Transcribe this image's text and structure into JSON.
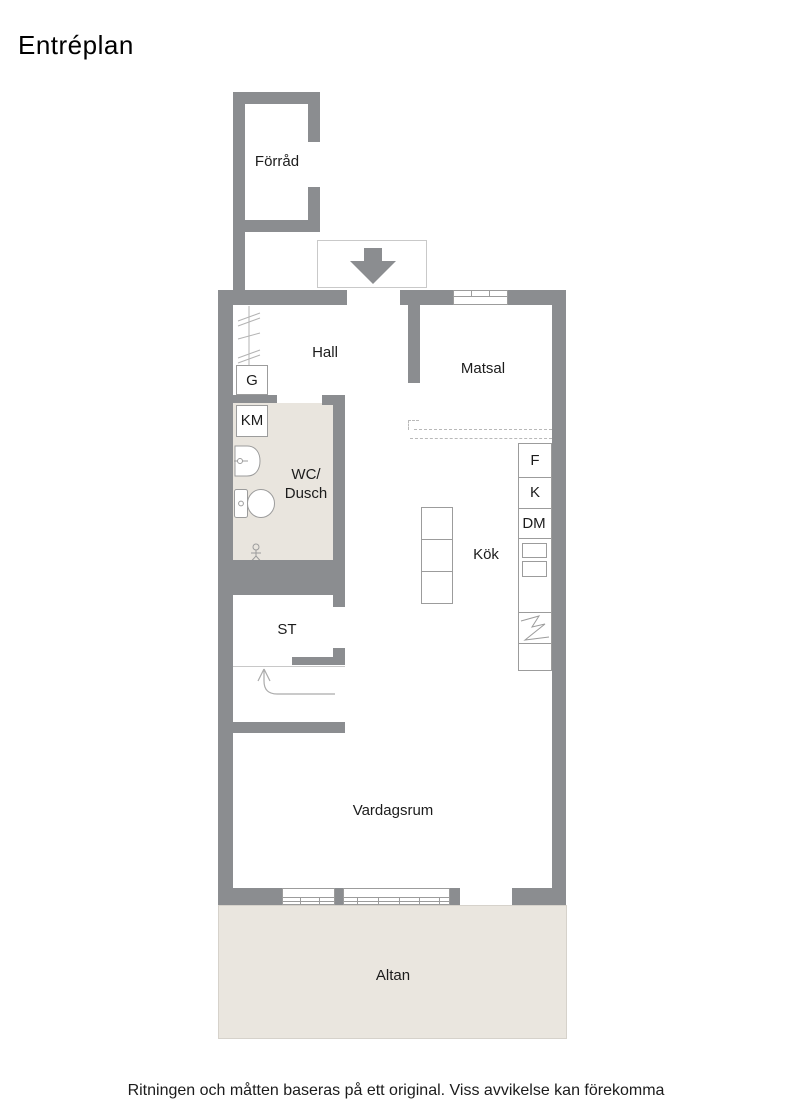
{
  "title": "Entréplan",
  "floor_plan": {
    "rooms": {
      "forrad": "Förråd",
      "hall": "Hall",
      "matsal": "Matsal",
      "wc_line1": "WC/",
      "wc_line2": "Dusch",
      "kok": "Kök",
      "st": "ST",
      "vardagsrum": "Vardagsrum",
      "altan": "Altan"
    },
    "fixtures": {
      "g": "G",
      "km": "KM",
      "f": "F",
      "k": "K",
      "dm": "DM"
    },
    "icons": {
      "entrance_arrow": "down-arrow",
      "stair_arrow": "curved-up-arrow",
      "sink": "basin",
      "toilet": "wc",
      "floor_drain": "drain",
      "wardrobe_hatch": "hatch-lines",
      "stove": "two-burners",
      "counter_break": "zigzag",
      "window": "paned-window"
    },
    "colors": {
      "wall": "#8b8d90",
      "wet_room_floor": "#e9e5de",
      "terrace_floor": "#eae6df"
    }
  },
  "footer": {
    "disclaimer": "Ritningen och måtten baseras på ett original. Viss avvikelse kan förekomma"
  }
}
